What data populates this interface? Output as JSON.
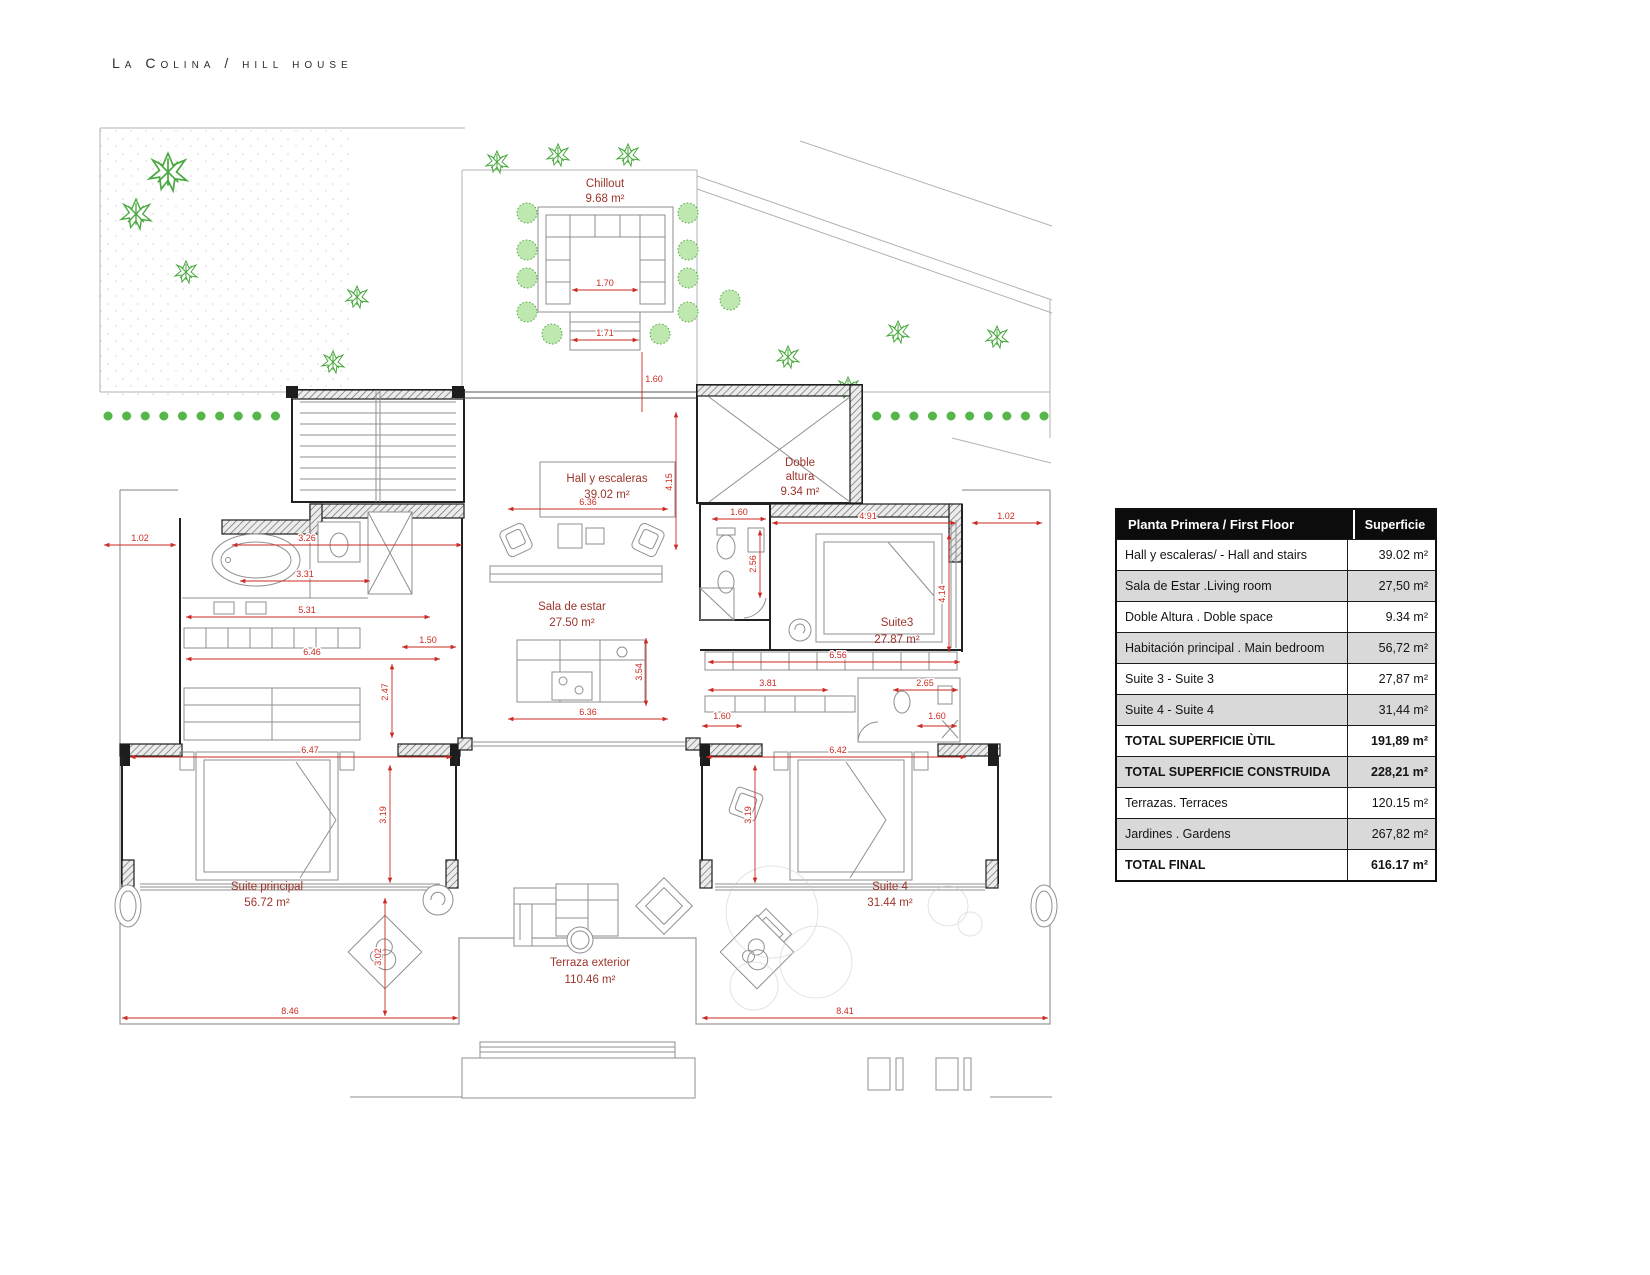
{
  "page": {
    "title": "La Colina / hill house"
  },
  "plan": {
    "rooms": [
      {
        "name": "Chillout",
        "area": "9.68 m²"
      },
      {
        "name": "Hall y escaleras",
        "area": "39.02 m²"
      },
      {
        "name": "Doble",
        "name2": "altura",
        "area": "9.34 m²"
      },
      {
        "name": "Sala de estar",
        "area": "27.50 m²"
      },
      {
        "name": "Suite3",
        "area": "27.87 m²"
      },
      {
        "name": "Suite principal",
        "area": "56.72 m²"
      },
      {
        "name": "Suite 4",
        "area": "31.44 m²"
      },
      {
        "name": "Terraza exterior",
        "area": "110.46 m²"
      }
    ],
    "dims": [
      "1.02",
      "3.26",
      "3.31",
      "5.31",
      "6.46",
      "1.50",
      "2.47",
      "6.47",
      "3.19",
      "8.46",
      "3.02",
      "4.15",
      "6.36",
      "6.36",
      "3.54",
      "1.60",
      "2.56",
      "4.91",
      "1.02",
      "4.14",
      "6.56",
      "3.81",
      "2.65",
      "1.60",
      "1.60",
      "6.42",
      "3.19",
      "8.41",
      "1.70",
      "1.71",
      "1.60"
    ]
  },
  "table": {
    "header": {
      "col1": "Planta Primera / First Floor",
      "col2": "Superficie"
    },
    "rows": [
      {
        "label": "Hall y escaleras/ - Hall and stairs",
        "value": "39.02 m²"
      },
      {
        "label": "Sala de Estar .Living room",
        "value": "27,50 m²"
      },
      {
        "label": "Doble Altura . Doble space",
        "value": "9.34 m²"
      },
      {
        "label": "Habitación principal . Main bedroom",
        "value": "56,72 m²"
      },
      {
        "label": "Suite 3 - Suite 3",
        "value": "27,87 m²"
      },
      {
        "label": "Suite 4 - Suite 4",
        "value": "31,44 m²"
      },
      {
        "label": "TOTAL SUPERFICIE ÙTIL",
        "value": "191,89 m²"
      },
      {
        "label": "TOTAL SUPERFICIE CONSTRUIDA",
        "value": "228,21 m²"
      },
      {
        "label": "Terrazas. Terraces",
        "value": "120.15 m²"
      },
      {
        "label": "Jardines . Gardens",
        "value": "267,82 m²"
      },
      {
        "label": "TOTAL FINAL",
        "value": "616.17 m²"
      }
    ]
  }
}
